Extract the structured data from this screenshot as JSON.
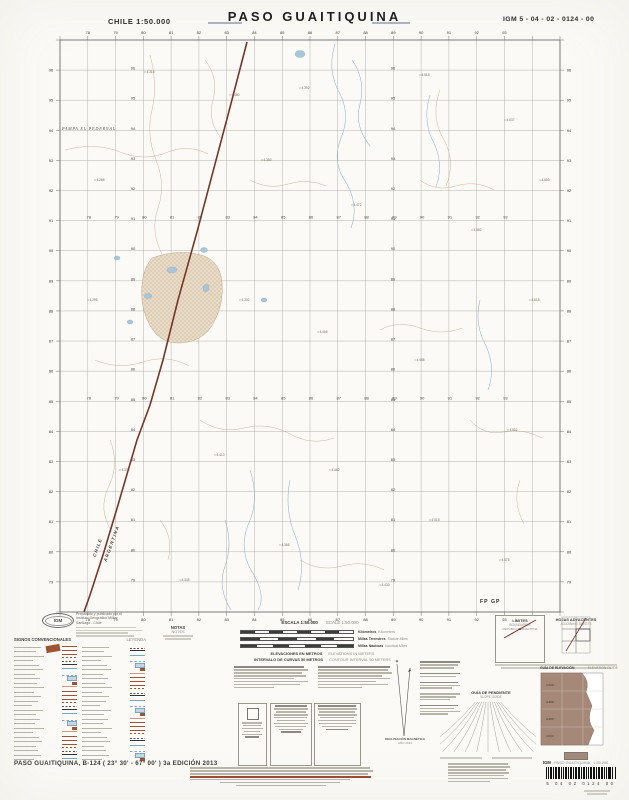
{
  "header": {
    "country_scale": "CHILE 1:50.000",
    "title": "PASO GUAITIQUINA",
    "sheet_code": "IGM 5 - 04 - 02 - 0124 - 00"
  },
  "map": {
    "easting_labels": [
      "78",
      "79",
      "80",
      "81",
      "82",
      "83",
      "84",
      "85",
      "86",
      "87",
      "88",
      "89",
      "90",
      "91",
      "92",
      "93"
    ],
    "northing_labels": [
      "96",
      "95",
      "94",
      "93",
      "92",
      "91",
      "90",
      "89",
      "88",
      "87",
      "86",
      "85",
      "84",
      "83",
      "82",
      "81",
      "80",
      "79"
    ],
    "boundary_label_left": "CHILE",
    "boundary_label_right": "ARGENTINA",
    "pampa_label": "PAMPA EL PEDERNAL",
    "map_note": "FP GP",
    "spot_elevations": [
      {
        "x": 145,
        "y": 72,
        "v": "4.316"
      },
      {
        "x": 230,
        "y": 95,
        "v": "4.480"
      },
      {
        "x": 300,
        "y": 88,
        "v": "4.392"
      },
      {
        "x": 420,
        "y": 75,
        "v": "4.515"
      },
      {
        "x": 505,
        "y": 120,
        "v": "4.637"
      },
      {
        "x": 95,
        "y": 180,
        "v": "4.268"
      },
      {
        "x": 262,
        "y": 160,
        "v": "4.350"
      },
      {
        "x": 352,
        "y": 205,
        "v": "4.472"
      },
      {
        "x": 472,
        "y": 230,
        "v": "4.560"
      },
      {
        "x": 530,
        "y": 300,
        "v": "4.618"
      },
      {
        "x": 88,
        "y": 300,
        "v": "4.295"
      },
      {
        "x": 240,
        "y": 300,
        "v": "4.330"
      },
      {
        "x": 318,
        "y": 332,
        "v": "4.405"
      },
      {
        "x": 415,
        "y": 360,
        "v": "4.488"
      },
      {
        "x": 508,
        "y": 430,
        "v": "4.552"
      },
      {
        "x": 120,
        "y": 470,
        "v": "4.370"
      },
      {
        "x": 215,
        "y": 455,
        "v": "4.410"
      },
      {
        "x": 330,
        "y": 470,
        "v": "4.462"
      },
      {
        "x": 430,
        "y": 520,
        "v": "4.518"
      },
      {
        "x": 280,
        "y": 545,
        "v": "4.385"
      },
      {
        "x": 180,
        "y": 580,
        "v": "4.345"
      },
      {
        "x": 380,
        "y": 585,
        "v": "4.430"
      },
      {
        "x": 500,
        "y": 560,
        "v": "4.575"
      },
      {
        "x": 540,
        "y": 180,
        "v": "4.650"
      }
    ]
  },
  "legend": {
    "title": "SIGNOS CONVENCIONALES",
    "title_right": "LEYENDA",
    "symbol_types": [
      "road-solid",
      "road-double",
      "track-dashed",
      "path-dashed",
      "railway",
      "stream",
      "canal-dashed",
      "lake",
      "building",
      "contour"
    ]
  },
  "footer": {
    "producer": {
      "logo": "IGM",
      "line1": "Preparado y publicado por el",
      "line2": "Instituto Geográfico Militar",
      "line3": "Santiago - Chile"
    },
    "notas": "NOTAS",
    "notes": "NOTES",
    "escala": "ESCALA 1:50.000",
    "scale": "SCALE 1:50.000",
    "scale_bars": [
      {
        "es": "Kilómetros",
        "en": "Kilometers"
      },
      {
        "es": "Millas Terrestres",
        "en": "Statute Miles"
      },
      {
        "es": "Millas Náuticas",
        "en": "Nautical Miles"
      }
    ],
    "elev_es": "ELEVACIONES EN METROS",
    "elev_en": "ELEVATIONS IN METERS",
    "interval_es": "INTERVALO DE CURVAS 50 METROS",
    "interval_en": "CONTOUR INTERVAL 50 METERS",
    "limites": {
      "title": "LÍMITES",
      "subtitle": "BOUNDARIES",
      "caption": "REPÚBLICA ARGENTINA"
    },
    "hojas": {
      "title": "HOJAS ADYACENTES",
      "subtitle": "ADJOINING SHEETS"
    },
    "pendiente": {
      "title": "GUÍA DE PENDIENTE",
      "subtitle": "SLOPE GUIDE"
    },
    "elevguide": {
      "title": "GUÍA DE ELEVACIÓN",
      "subtitle": "ELEVATION GUIDE",
      "values": [
        "4.600",
        "4.400",
        "4.200",
        "4.000"
      ]
    },
    "declinacion": {
      "title": "DECLINACIÓN MAGNÉTICA",
      "subtitle": "AÑO 2013"
    },
    "igm_line": " - PASO GUAITIQUINA - 1:50.000",
    "igm_bold": "IGM",
    "barcode_digits": "5 04 02 0124 00",
    "edition_line": "PASO GUAITIQUINA, B-124 ( 23° 30' - 67° 00' ) 3a EDICIÓN 2013"
  }
}
